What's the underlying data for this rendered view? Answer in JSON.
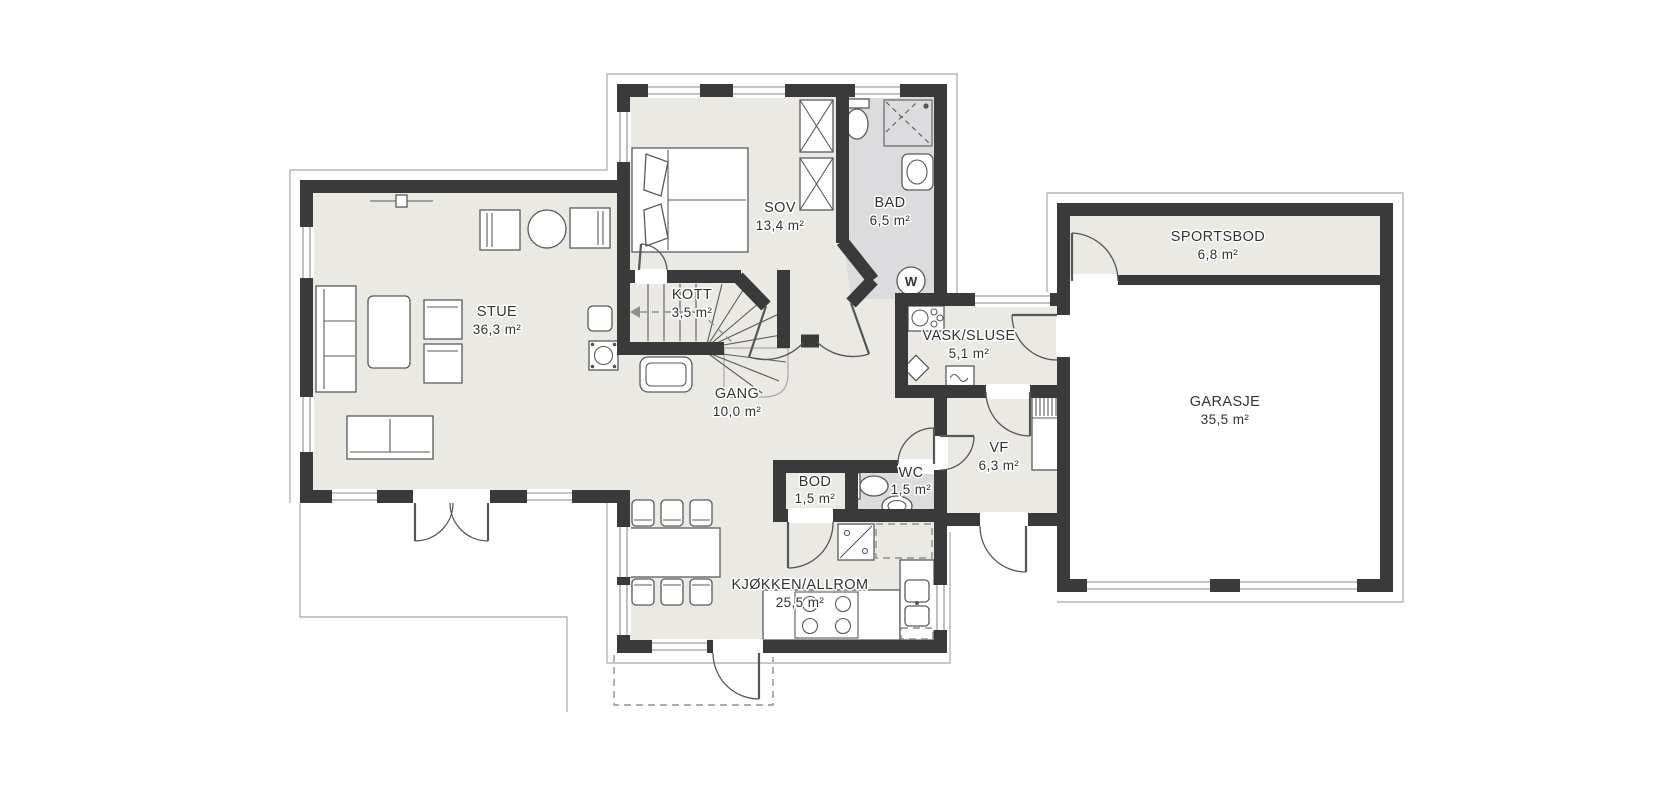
{
  "title": "floor-plan",
  "colors": {
    "wall": "#3a3a3a",
    "floor": "#ebe9e3",
    "wet_room_floor": "#dcdcde",
    "outline": "#5a5a5a",
    "label": "#333333"
  },
  "rooms": [
    {
      "id": "stue",
      "name": "STUE",
      "area": "36,3 m²",
      "label_x": 497,
      "label_y": 316
    },
    {
      "id": "sov",
      "name": "SOV",
      "area": "13,4 m²",
      "label_x": 780,
      "label_y": 212
    },
    {
      "id": "bad",
      "name": "BAD",
      "area": "6,5 m²",
      "label_x": 890,
      "label_y": 207
    },
    {
      "id": "kott",
      "name": "KOTT",
      "area": "3,5 m²",
      "label_x": 692,
      "label_y": 299
    },
    {
      "id": "gang",
      "name": "GANG",
      "area": "10,0 m²",
      "label_x": 737,
      "label_y": 398
    },
    {
      "id": "vask",
      "name": "VASK/SLUSE",
      "area": "5,1 m²",
      "label_x": 969,
      "label_y": 340
    },
    {
      "id": "vf",
      "name": "VF",
      "area": "6,3 m²",
      "label_x": 999,
      "label_y": 452
    },
    {
      "id": "wc",
      "name": "WC",
      "area": "1,5 m²",
      "label_x": 911,
      "label_y": 477
    },
    {
      "id": "bod",
      "name": "BOD",
      "area": "1,5 m²",
      "label_x": 815,
      "label_y": 486
    },
    {
      "id": "kjokken",
      "name": "KJØKKEN/ALLROM",
      "area": "25,5 m²",
      "label_x": 800,
      "label_y": 589
    },
    {
      "id": "sportsbod",
      "name": "SPORTSBOD",
      "area": "6,8 m²",
      "label_x": 1218,
      "label_y": 241
    },
    {
      "id": "garasje",
      "name": "GARASJE",
      "area": "35,5 m²",
      "label_x": 1225,
      "label_y": 406
    }
  ],
  "fixtures": {
    "water_heater_symbol": "W"
  }
}
